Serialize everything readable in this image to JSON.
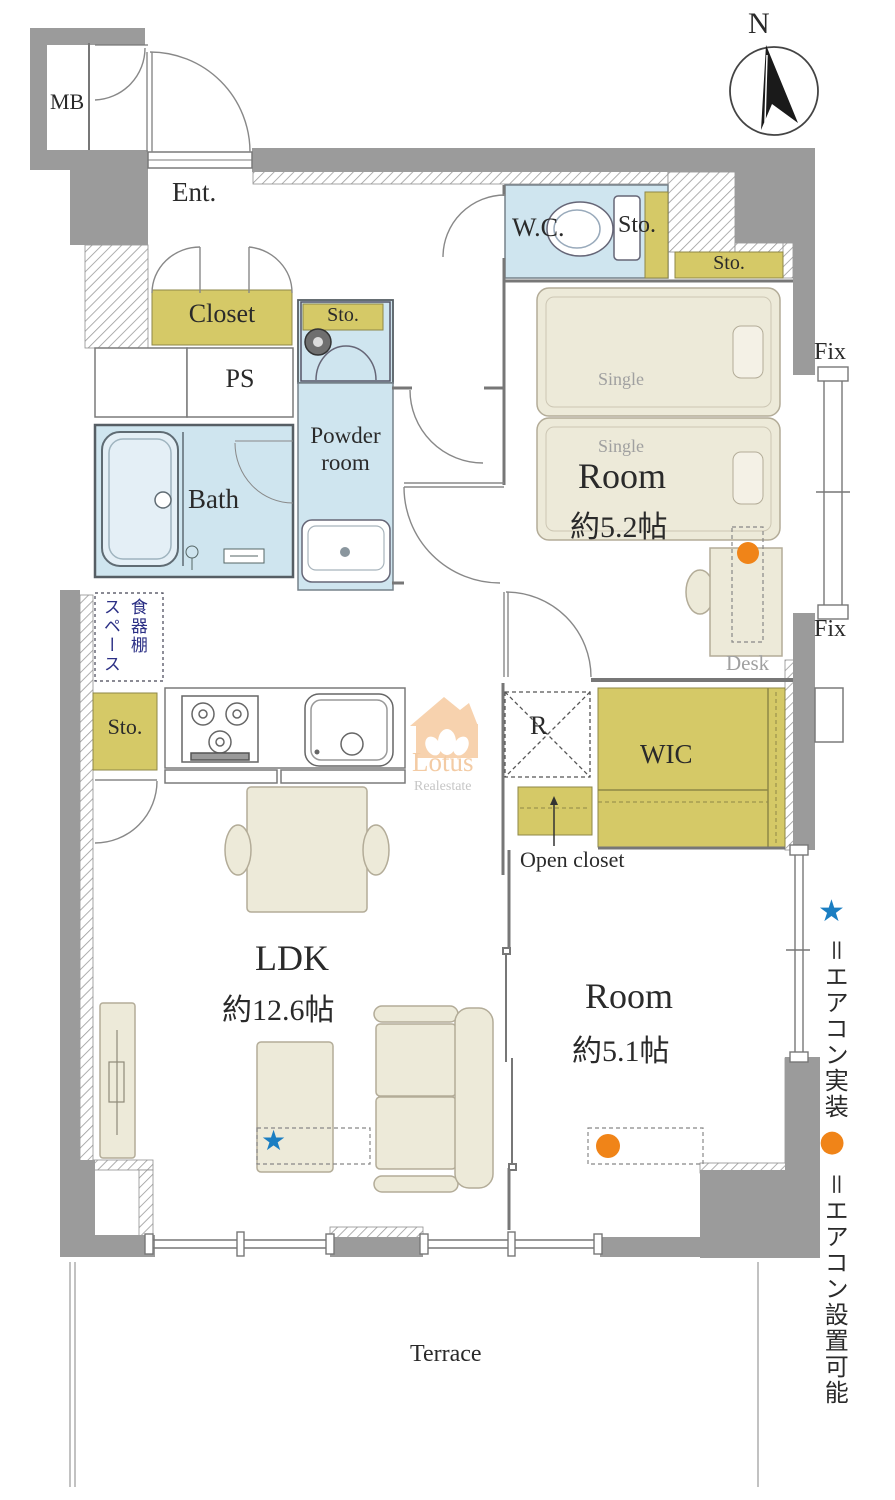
{
  "compass": {
    "north": "N"
  },
  "rooms": {
    "mb": "MB",
    "entrance": "Ent.",
    "closet": "Closet",
    "ps": "PS",
    "laundry_storage": "Sto.",
    "bath": "Bath",
    "powder_room_line1": "Powder",
    "powder_room_line2": "room",
    "wc": "W.C.",
    "wc_storage": "Sto.",
    "bedroom1_storage": "Sto.",
    "bedroom1_name": "Room",
    "bedroom1_size": "約5.2帖",
    "refrigerator": "R",
    "wic": "WIC",
    "open_closet": "Open closet",
    "kitchen_storage": "Sto.",
    "cupboard_space_col1": "食器棚",
    "cupboard_space_col2": "スペース",
    "ldk_name": "LDK",
    "ldk_size": "約12.6帖",
    "bedroom2_name": "Room",
    "bedroom2_size": "約5.1帖",
    "terrace": "Terrace"
  },
  "furniture": {
    "bed1": "Single",
    "bed2": "Single",
    "desk": "Desk"
  },
  "windows": {
    "fix_top": "Fix",
    "fix_bottom": "Fix"
  },
  "legend": {
    "star_symbol": "★",
    "star_text": "＝エアコン実装",
    "dot_symbol": "●",
    "dot_text": "＝エアコン設置可能"
  },
  "watermark": {
    "name": "Lotus",
    "subtitle": "Realestate"
  },
  "colors": {
    "wall_gray": "#9b9b9b",
    "water_blue": "#cfe5ef",
    "storage_yellow": "#d5c967",
    "furniture_beige": "#edead9",
    "star_blue": "#1b7ec2",
    "ac_orange": "#f08418",
    "note_navy": "#2b2f85",
    "watermark_peach": "#f7d2ae"
  }
}
